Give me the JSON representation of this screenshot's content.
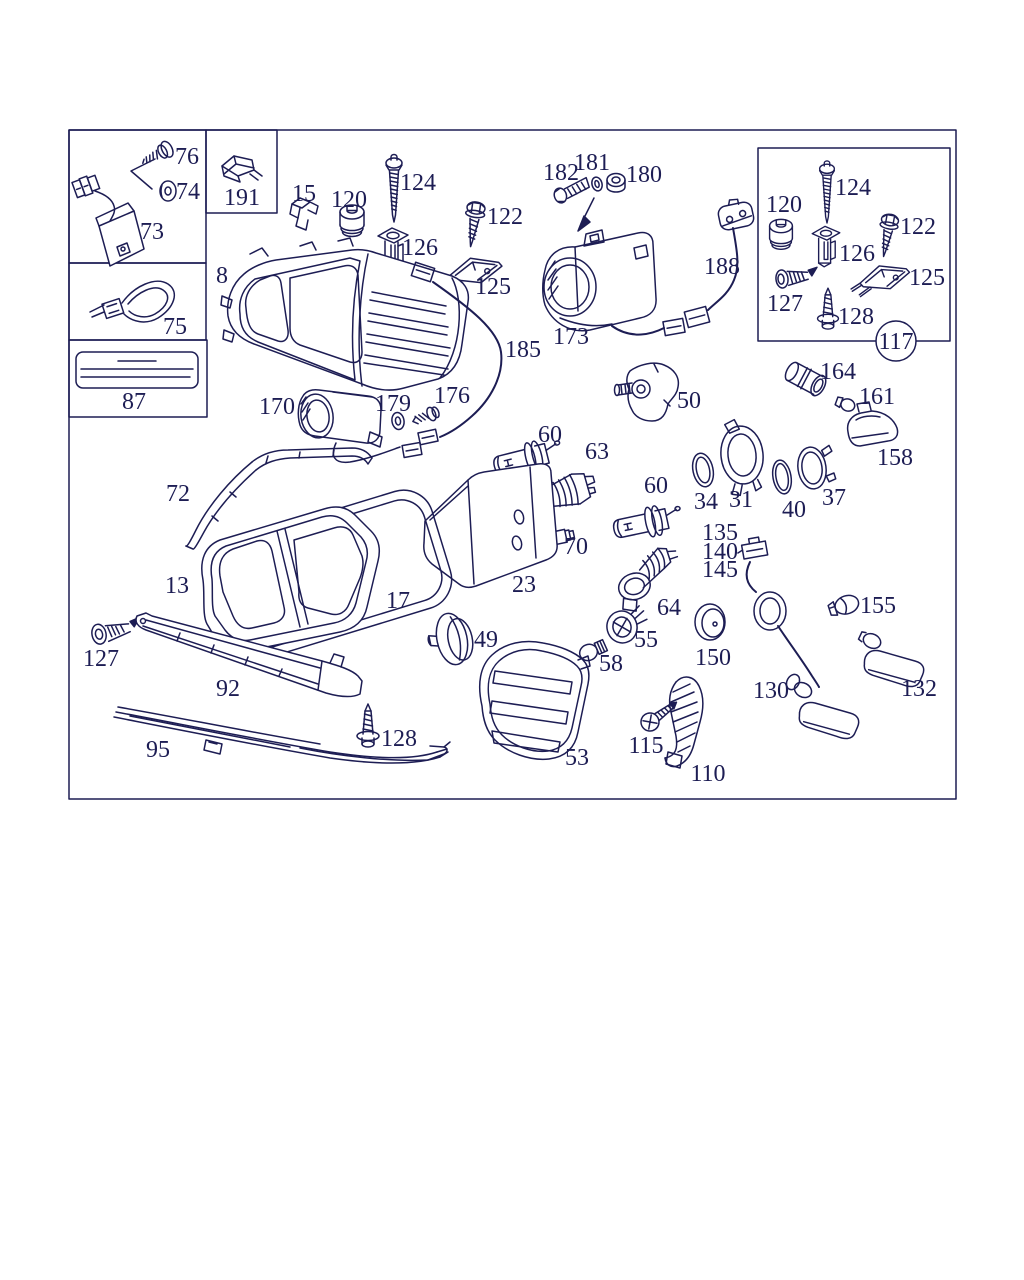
{
  "page": {
    "background": "#ffffff",
    "ink_color": "#1d1d54"
  },
  "diagram": {
    "labels": [
      {
        "id": "76",
        "text": "76",
        "x": 187,
        "y": 156
      },
      {
        "id": "74",
        "text": "74",
        "x": 188,
        "y": 191
      },
      {
        "id": "73",
        "text": "73",
        "x": 152,
        "y": 231
      },
      {
        "id": "191",
        "text": "191",
        "x": 242,
        "y": 197
      },
      {
        "id": "75",
        "text": "75",
        "x": 175,
        "y": 326
      },
      {
        "id": "87",
        "text": "87",
        "x": 134,
        "y": 401
      },
      {
        "id": "8",
        "text": "8",
        "x": 222,
        "y": 275
      },
      {
        "id": "15",
        "text": "15",
        "x": 304,
        "y": 193
      },
      {
        "id": "120a",
        "text": "120",
        "x": 349,
        "y": 199
      },
      {
        "id": "124a",
        "text": "124",
        "x": 418,
        "y": 182
      },
      {
        "id": "126a",
        "text": "126",
        "x": 420,
        "y": 247
      },
      {
        "id": "122a",
        "text": "122",
        "x": 505,
        "y": 216
      },
      {
        "id": "125a",
        "text": "125",
        "x": 493,
        "y": 286
      },
      {
        "id": "182",
        "text": "182",
        "x": 561,
        "y": 172
      },
      {
        "id": "181",
        "text": "181",
        "x": 592,
        "y": 162
      },
      {
        "id": "180",
        "text": "180",
        "x": 644,
        "y": 174
      },
      {
        "id": "173",
        "text": "173",
        "x": 571,
        "y": 336
      },
      {
        "id": "188",
        "text": "188",
        "x": 722,
        "y": 266
      },
      {
        "id": "120b",
        "text": "120",
        "x": 784,
        "y": 204
      },
      {
        "id": "124b",
        "text": "124",
        "x": 853,
        "y": 187
      },
      {
        "id": "122b",
        "text": "122",
        "x": 918,
        "y": 226
      },
      {
        "id": "126b",
        "text": "126",
        "x": 857,
        "y": 253
      },
      {
        "id": "127a",
        "text": "127",
        "x": 785,
        "y": 303
      },
      {
        "id": "125b",
        "text": "125",
        "x": 927,
        "y": 277
      },
      {
        "id": "128a",
        "text": "128",
        "x": 856,
        "y": 316
      },
      {
        "id": "164",
        "text": "164",
        "x": 838,
        "y": 371
      },
      {
        "id": "161",
        "text": "161",
        "x": 877,
        "y": 396
      },
      {
        "id": "158",
        "text": "158",
        "x": 895,
        "y": 457
      },
      {
        "id": "50",
        "text": "50",
        "x": 689,
        "y": 400
      },
      {
        "id": "60a",
        "text": "60",
        "x": 550,
        "y": 434
      },
      {
        "id": "63",
        "text": "63",
        "x": 597,
        "y": 451
      },
      {
        "id": "60b",
        "text": "60",
        "x": 656,
        "y": 485
      },
      {
        "id": "34",
        "text": "34",
        "x": 706,
        "y": 501
      },
      {
        "id": "31",
        "text": "31",
        "x": 741,
        "y": 499
      },
      {
        "id": "40",
        "text": "40",
        "x": 794,
        "y": 509
      },
      {
        "id": "37",
        "text": "37",
        "x": 834,
        "y": 497
      },
      {
        "id": "70",
        "text": "70",
        "x": 576,
        "y": 546
      },
      {
        "id": "23",
        "text": "23",
        "x": 524,
        "y": 584
      },
      {
        "id": "64",
        "text": "64",
        "x": 669,
        "y": 607
      },
      {
        "id": "170",
        "text": "170",
        "x": 277,
        "y": 406
      },
      {
        "id": "179",
        "text": "179",
        "x": 393,
        "y": 403
      },
      {
        "id": "176",
        "text": "176",
        "x": 452,
        "y": 395
      },
      {
        "id": "185",
        "text": "185",
        "x": 523,
        "y": 349
      },
      {
        "id": "72",
        "text": "72",
        "x": 178,
        "y": 493
      },
      {
        "id": "13",
        "text": "13",
        "x": 177,
        "y": 585
      },
      {
        "id": "17",
        "text": "17",
        "x": 398,
        "y": 600
      },
      {
        "id": "127b",
        "text": "127",
        "x": 101,
        "y": 658
      },
      {
        "id": "92",
        "text": "92",
        "x": 228,
        "y": 688
      },
      {
        "id": "95",
        "text": "95",
        "x": 158,
        "y": 749
      },
      {
        "id": "128b",
        "text": "128",
        "x": 399,
        "y": 738
      },
      {
        "id": "49",
        "text": "49",
        "x": 486,
        "y": 639
      },
      {
        "id": "53",
        "text": "53",
        "x": 577,
        "y": 757
      },
      {
        "id": "58",
        "text": "58",
        "x": 611,
        "y": 663
      },
      {
        "id": "55",
        "text": "55",
        "x": 646,
        "y": 639
      },
      {
        "id": "150",
        "text": "150",
        "x": 713,
        "y": 657
      },
      {
        "id": "115",
        "text": "115",
        "x": 646,
        "y": 745
      },
      {
        "id": "110",
        "text": "110",
        "x": 708,
        "y": 773
      },
      {
        "id": "135",
        "text": "135",
        "x": 720,
        "y": 532
      },
      {
        "id": "140",
        "text": "140",
        "x": 720,
        "y": 551
      },
      {
        "id": "145",
        "text": "145",
        "x": 720,
        "y": 569
      },
      {
        "id": "155",
        "text": "155",
        "x": 878,
        "y": 605
      },
      {
        "id": "130",
        "text": "130",
        "x": 771,
        "y": 690
      },
      {
        "id": "132",
        "text": "132",
        "x": 919,
        "y": 688
      }
    ],
    "circled_labels": [
      {
        "id": "117",
        "text": "117",
        "x": 896,
        "y": 341,
        "r": 20
      }
    ]
  }
}
